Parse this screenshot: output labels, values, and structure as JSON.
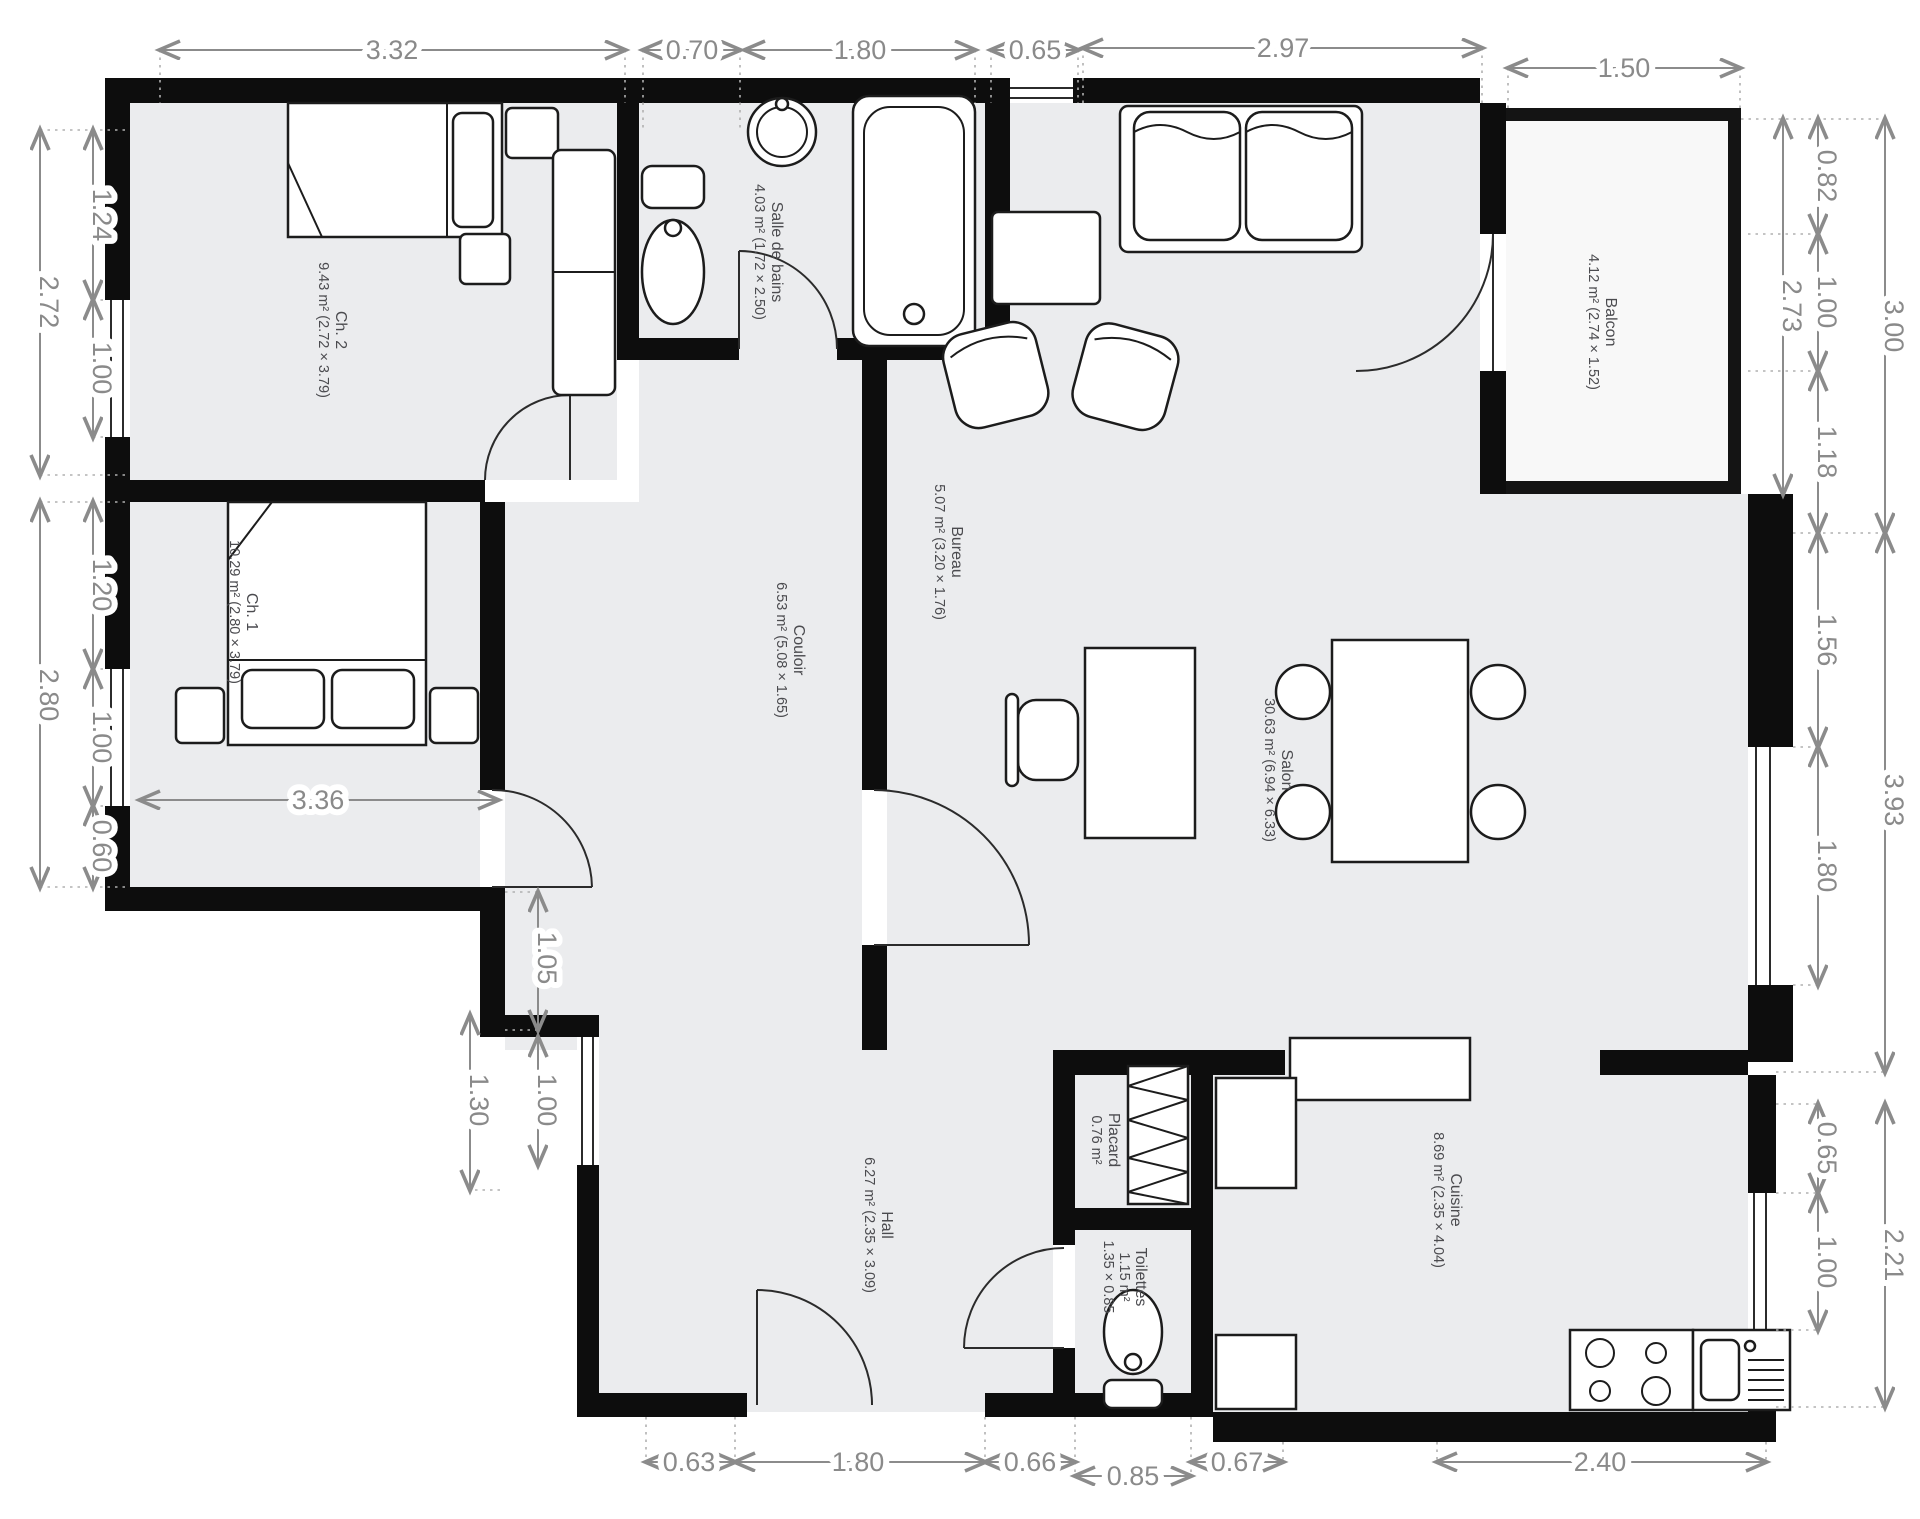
{
  "title": "Plan d'appartement",
  "units": "m",
  "colors": {
    "wall": "#0d0d0d",
    "room_fill": "#ebecee",
    "balcony_fill": "#f8f8f8",
    "dimension_gray": "#8b8b8b",
    "label_gray": "#4b4b4f",
    "background": "#ffffff"
  },
  "rooms": {
    "ch2": {
      "name": "Ch. 2",
      "area": "9.43 m² (2.72 × 3.79)"
    },
    "ch1": {
      "name": "Ch. 1",
      "area": "10.29 m² (2.80 × 3.79)"
    },
    "sdb": {
      "name": "Salle de bains",
      "area": "4.03 m² (1.72 × 2.50)"
    },
    "bureau": {
      "name": "Bureau",
      "area": "5.07 m² (3.20 × 1.76)"
    },
    "couloir": {
      "name": "Couloir",
      "area": "6.53 m² (5.08 × 1.65)"
    },
    "salon": {
      "name": "Salon",
      "area": "30.63 m² (6.94 × 6.33)"
    },
    "balcon": {
      "name": "Balcon",
      "area": "4.12 m² (2.74 × 1.52)"
    },
    "hall": {
      "name": "Hall",
      "area": "6.27 m² (2.35 × 3.09)"
    },
    "placard": {
      "name": "Placard",
      "area": "0.76 m²"
    },
    "toilettes": {
      "name": "Toilettes",
      "area": "1.15 m²",
      "area2": "1.35 × 0.85"
    },
    "cuisine": {
      "name": "Cuisine",
      "area": "8.69 m² (2.35 × 4.04)"
    }
  },
  "dims": {
    "top": [
      "3.32",
      "0.70",
      "1.80",
      "0.65",
      "2.97",
      "1.50"
    ],
    "left": [
      "2.72",
      "1.24",
      "1.00",
      "2.80",
      "1.20",
      "1.00",
      "0.60"
    ],
    "right": [
      "0.82",
      "1.00",
      "1.18",
      "1.56",
      "1.80",
      "2.73",
      "3.00",
      "3.93",
      "0.65",
      "1.00",
      "2.21"
    ],
    "bottom": [
      "0.63",
      "1.80",
      "0.66",
      "0.85",
      "0.67",
      "2.40"
    ],
    "inner": [
      "3.36",
      "1.05",
      "1.00",
      "1.30"
    ]
  }
}
